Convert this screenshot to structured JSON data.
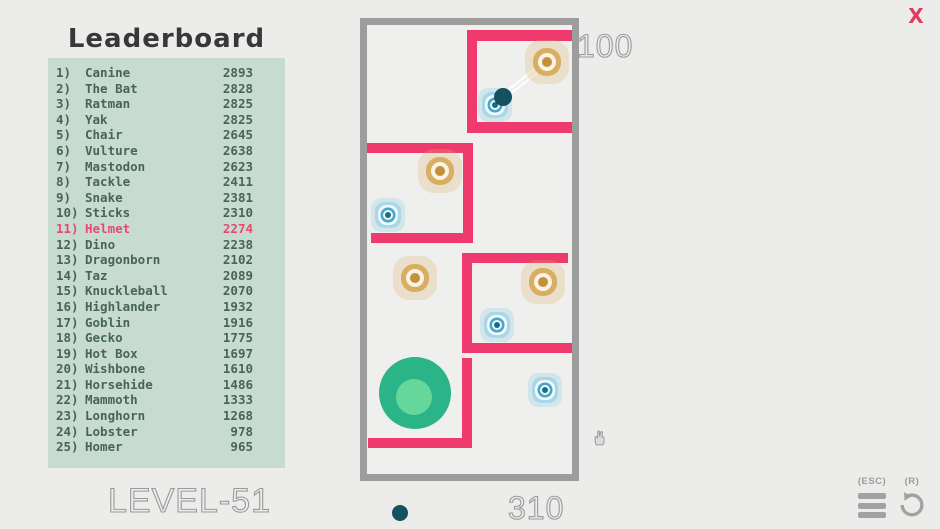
{
  "close_button": {
    "label": "X",
    "color": "#e23b62"
  },
  "leaderboard": {
    "title": "Leaderboard",
    "entries": [
      {
        "rank": "1)",
        "name": "Canine",
        "score": "2893"
      },
      {
        "rank": "2)",
        "name": "The Bat",
        "score": "2828"
      },
      {
        "rank": "3)",
        "name": "Ratman",
        "score": "2825"
      },
      {
        "rank": "4)",
        "name": "Yak",
        "score": "2825"
      },
      {
        "rank": "5)",
        "name": "Chair",
        "score": "2645"
      },
      {
        "rank": "6)",
        "name": "Vulture",
        "score": "2638"
      },
      {
        "rank": "7)",
        "name": "Mastodon",
        "score": "2623"
      },
      {
        "rank": "8)",
        "name": "Tackle",
        "score": "2411"
      },
      {
        "rank": "9)",
        "name": "Snake",
        "score": "2381"
      },
      {
        "rank": "10)",
        "name": "Sticks",
        "score": "2310"
      },
      {
        "rank": "11)",
        "name": "Helmet",
        "score": "2274",
        "highlight": true
      },
      {
        "rank": "12)",
        "name": "Dino",
        "score": "2238"
      },
      {
        "rank": "13)",
        "name": "Dragonborn",
        "score": "2102"
      },
      {
        "rank": "14)",
        "name": "Taz",
        "score": "2089"
      },
      {
        "rank": "15)",
        "name": "Knuckleball",
        "score": "2070"
      },
      {
        "rank": "16)",
        "name": "Highlander",
        "score": "1932"
      },
      {
        "rank": "17)",
        "name": "Goblin",
        "score": "1916"
      },
      {
        "rank": "18)",
        "name": "Gecko",
        "score": "1775"
      },
      {
        "rank": "19)",
        "name": "Hot Box",
        "score": "1697"
      },
      {
        "rank": "20)",
        "name": "Wishbone",
        "score": "1610"
      },
      {
        "rank": "21)",
        "name": "Horsehide",
        "score": "1486"
      },
      {
        "rank": "22)",
        "name": "Mammoth",
        "score": "1333"
      },
      {
        "rank": "23)",
        "name": "Longhorn",
        "score": "1268"
      },
      {
        "rank": "24)",
        "name": "Lobster",
        "score": "978"
      },
      {
        "rank": "25)",
        "name": "Homer",
        "score": "965"
      }
    ]
  },
  "level_label": "LEVEL-51",
  "hud": {
    "score_top": "100",
    "score_bottom": "310"
  },
  "controls": {
    "menu_key_label": "(ESC)",
    "restart_key_label": "(R)"
  },
  "game": {
    "colors": {
      "wall": "#ef3a6d",
      "border": "#9d9d9d",
      "ball": "#14525f",
      "exit_outer": "#2ab487",
      "exit_inner": "#66d79b",
      "target_orange": "#d9ae62",
      "target_blue": "#a8d7e7",
      "panel": "#c7dbd1",
      "highlight": "#e64a6e"
    },
    "walls": [
      {
        "x": 100,
        "y": 5,
        "w": 105,
        "h": 11
      },
      {
        "x": 100,
        "y": 5,
        "w": 10,
        "h": 103
      },
      {
        "x": 100,
        "y": 97,
        "w": 105,
        "h": 11
      },
      {
        "x": 0,
        "y": 118,
        "w": 106,
        "h": 10
      },
      {
        "x": 96,
        "y": 118,
        "w": 10,
        "h": 100
      },
      {
        "x": 4,
        "y": 208,
        "w": 102,
        "h": 10
      },
      {
        "x": 95,
        "y": 228,
        "w": 106,
        "h": 10
      },
      {
        "x": 95,
        "y": 228,
        "w": 10,
        "h": 100
      },
      {
        "x": 95,
        "y": 318,
        "w": 110,
        "h": 10
      },
      {
        "x": 95,
        "y": 333,
        "w": 10,
        "h": 90
      },
      {
        "x": 1,
        "y": 413,
        "w": 104,
        "h": 10
      }
    ],
    "targets": [
      {
        "type": "orange",
        "x": 180,
        "y": 37
      },
      {
        "type": "blue",
        "x": 128,
        "y": 80
      },
      {
        "type": "orange",
        "x": 73,
        "y": 146
      },
      {
        "type": "blue",
        "x": 21,
        "y": 190
      },
      {
        "type": "orange",
        "x": 48,
        "y": 253
      },
      {
        "type": "orange",
        "x": 176,
        "y": 257
      },
      {
        "type": "blue",
        "x": 130,
        "y": 300
      },
      {
        "type": "blue",
        "x": 178,
        "y": 365
      }
    ],
    "ball": {
      "x": 136,
      "y": 72
    },
    "trails": [
      {
        "x1": 137.4,
        "y1": 73.7,
        "x2": 181.4,
        "y2": 38.7
      },
      {
        "x1": 134.6,
        "y1": 70.3,
        "x2": 178.6,
        "y2": 35.3
      }
    ],
    "exit": {
      "x": 48,
      "y": 368
    }
  }
}
